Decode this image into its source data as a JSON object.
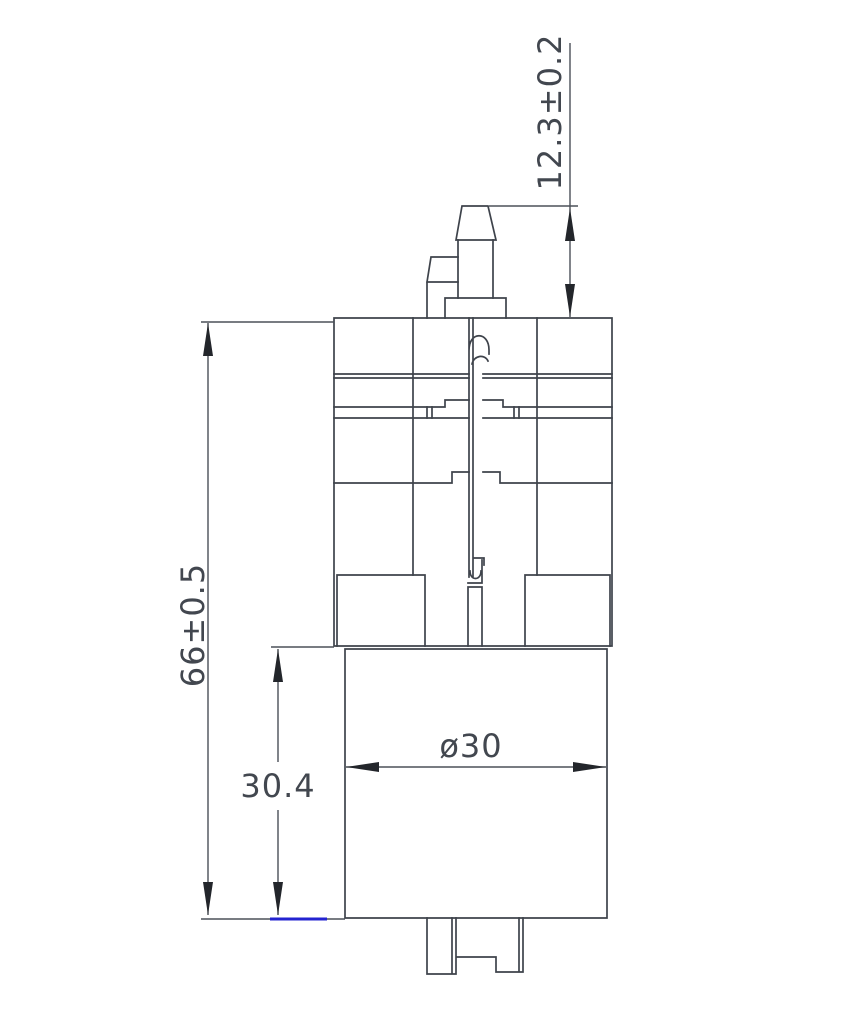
{
  "drawing": {
    "view": "pump-motor-assembly-cross-section",
    "background_color": "#ffffff",
    "line_color": "#3e434b",
    "dimension_line_color": "#4b5058",
    "arrow_color": "#23262b",
    "text_color": "#42474f",
    "highlight_color": "#2323d0"
  },
  "dimensions": {
    "nozzle_height": {
      "label": "12.3±0.2",
      "value": 12.3,
      "tolerance": 0.2,
      "orientation": "vertical"
    },
    "overall_height": {
      "label": "66±0.5",
      "value": 66,
      "tolerance": 0.5,
      "orientation": "vertical"
    },
    "motor_section_height": {
      "label": "30.4",
      "value": 30.4,
      "orientation": "vertical"
    },
    "motor_diameter": {
      "label": "ø30",
      "value": 30,
      "orientation": "horizontal"
    }
  }
}
